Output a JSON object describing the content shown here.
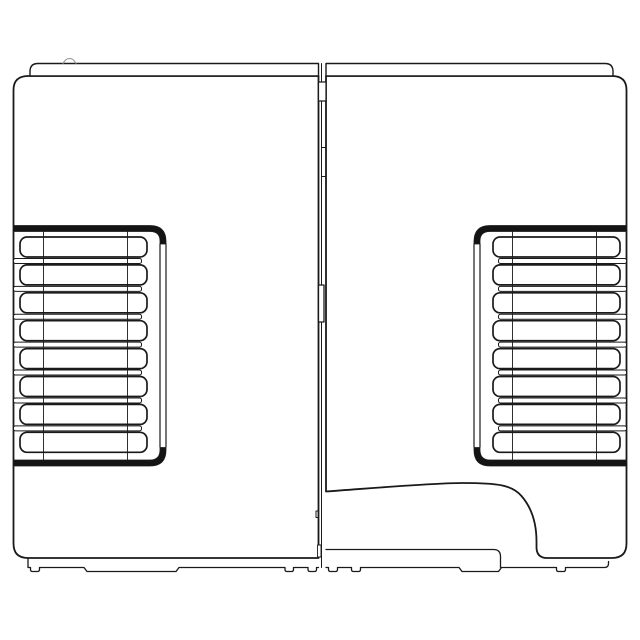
{
  "canvas": {
    "width": 640,
    "height": 640,
    "background_color": "#ffffff",
    "line_color": "#1a1a1a",
    "faint_line_color": "#8c8c8c",
    "band_fill_color": "#141414",
    "fill_color": "#ffffff"
  },
  "drawing": {
    "kind": "technical-line-drawing",
    "view": "front-elevation-two-panel-enclosure",
    "shapes": [
      {
        "name": "left-panel-body",
        "type": "path",
        "d": "M318.5 76 H28 Q13.5 76 13.5 90 V543.5 Q13.5 558 28 558 H318.5 Z",
        "stroke_width": 1.8,
        "fill": true
      },
      {
        "name": "right-panel-body",
        "type": "path",
        "d": "M326 491.5 C375 488 432 483 463 483 C498 483 512 485 521.5 496 C531 507 536.5 521 536.5 541.5 V547 Q536.5 558 547 558 H612 Q626.5 558 626.5 543.5 V90 Q626.5 76 612 76 H326 Z",
        "stroke_width": 1.8,
        "fill": true
      },
      {
        "name": "left-top-lid",
        "type": "path",
        "d": "M318.5 76 V63.5 H38 Q30 63.5 30 71.5 V76 Z",
        "stroke_width": 1.4,
        "fill": true
      },
      {
        "name": "right-top-lid",
        "type": "path",
        "d": "M326 76 V63.5 H605 Q613 63.5 613 71.5 V76 Z",
        "stroke_width": 1.4,
        "fill": true
      },
      {
        "name": "left-lid-bump-detail",
        "type": "path",
        "d": "M63 63.5 Q65.5 58.5 69.5 58.5 Q73.5 58.5 76 63.5",
        "stroke_width": 1,
        "fill": false,
        "faint": true
      },
      {
        "name": "left-base-skirt",
        "type": "path",
        "d": "M28 558 V567.5 H30.5 V569.5 Q30.5 571.5 32.5 571.5 H37.5 Q39.5 571.5 39.5 569.5 V567.5 H84 L87 571.5 H176 L179 567.5 H285 V569.5 Q285 571.5 287 571.5 H291.5 Q293.5 571.5 293.5 569.5 V567.5 H308 V569.5 Q308 571.5 310 571.5 H314.5 Q316.5 571.5 316.5 569.5 V567.5 H318.5",
        "stroke_width": 1.3,
        "fill": false
      },
      {
        "name": "right-compartment-bottom",
        "type": "path",
        "d": "M326 549.5 H493.5 Q500.5 549.5 500.5 556.5 V567.5",
        "stroke_width": 1.3,
        "fill": false
      },
      {
        "name": "right-base-skirt",
        "type": "path",
        "d": "M326 567.5 H328.5 V569.5 Q328.5 571.5 330.5 571.5 H335.5 Q337.5 571.5 337.5 569.5 V567.5 H351.5 V569.5 Q351.5 571.5 353.5 571.5 H358.5 Q360.5 571.5 360.5 569.5 V567.5 H459 L462 571.5 H498.5 L501.5 567.5 H556.5 V569.5 Q556.5 571.5 558.5 571.5 H563.5 Q565.5 571.5 565.5 569.5 V567.5 H604.5 Q608.5 567.5 608.5 563.5 V561.5",
        "stroke_width": 1.3,
        "fill": false
      },
      {
        "name": "center-seam-line",
        "type": "path",
        "d": "M321.5 63.5 V567.5",
        "stroke_width": 1,
        "fill": false
      },
      {
        "name": "seam-top-latch-block",
        "type": "path",
        "d": "M318.5 82 H326 V101 H318.5 Z",
        "stroke_width": 1.2,
        "fill": true
      },
      {
        "name": "seam-tick-marks",
        "type": "path",
        "d": "M321.5 147.5 H326 M321.5 176.5 H326",
        "stroke_width": 1,
        "fill": false
      },
      {
        "name": "seam-hinge-block",
        "type": "path",
        "d": "M318.5 285 H324 V322 H318.5 Z",
        "stroke_width": 1.3,
        "fill": true
      },
      {
        "name": "seam-lower-tick",
        "type": "path",
        "d": "M318.5 511 H316 V517.5 H318.5",
        "stroke_width": 1,
        "fill": false
      },
      {
        "name": "seam-bottom-block",
        "type": "path",
        "d": "M317.5 545 H321 V557 H317.5 Z",
        "stroke_width": 0.9,
        "fill": true
      },
      {
        "name": "left-grille-band-top",
        "type": "path",
        "d": "M13.5 225.5 H150 Q166 225.5 166 241.5 V244 H160 V241 Q160 231.5 150 231.5 H13.5 Z",
        "stroke_width": 0.8,
        "band": true
      },
      {
        "name": "left-grille-frame-right",
        "type": "path",
        "d": "M160 244 V447 M166 244 V447",
        "stroke_width": 1.2,
        "fill": false
      },
      {
        "name": "left-grille-band-bottom",
        "type": "path",
        "d": "M13.5 466 H150 Q166 466 166 450 V447.5 H160 V450 Q160 460 150 460 H13.5 Z",
        "stroke_width": 0.8,
        "band": true
      },
      {
        "name": "right-grille-band-top",
        "type": "path",
        "d": "M626.5 225.5 H490 Q474 225.5 474 241.5 V244 H480 V241 Q480 231.5 490 231.5 H626.5 Z",
        "stroke_width": 0.8,
        "band": true
      },
      {
        "name": "right-grille-frame-left",
        "type": "path",
        "d": "M474 244 V447 M480 244 V447",
        "stroke_width": 1.2,
        "fill": false
      },
      {
        "name": "right-grille-band-bottom",
        "type": "path",
        "d": "M626.5 466 H490 Q474 466 474 450 V447.5 H480 V450 Q480 460 490 460 H626.5 Z",
        "stroke_width": 0.8,
        "band": true
      }
    ],
    "grille": {
      "slot_count": 8,
      "fin_count": 7,
      "slot_first_y": 237,
      "slot_pitch": 27.9,
      "slot_height": 20,
      "slot_corner_radius": 7,
      "fin_height": 5,
      "fin_corner_radius": 2,
      "slot_stroke_width": 1.7,
      "fin_stroke_width": 1,
      "vline_stroke_width": 0.9,
      "vline_top_y": 231.5,
      "vline_bottom_y": 460,
      "sides": [
        {
          "name": "left",
          "slot_x": 20,
          "slot_width": 127,
          "fin_x": 13.5,
          "fin_width": 128,
          "vlines": [
            43.5,
            127.5
          ]
        },
        {
          "name": "right",
          "slot_x": 493,
          "slot_width": 127,
          "fin_x": 498.5,
          "fin_width": 128,
          "vlines": [
            512.5,
            596.5
          ]
        }
      ]
    }
  }
}
